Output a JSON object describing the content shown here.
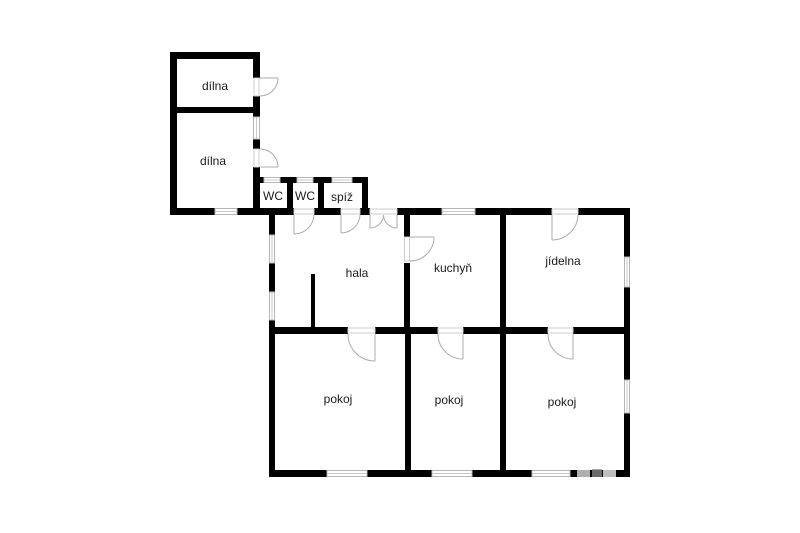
{
  "plan": {
    "type": "floor-plan",
    "background_color": "#ffffff",
    "wall_color": "#000000",
    "door_arc_color": "#ababab",
    "window_line_color": "#b5b5b5",
    "label_color": "#1a1a1a",
    "rooms": [
      {
        "id": "dilna-upper",
        "label": "dílna"
      },
      {
        "id": "dilna-lower",
        "label": "dílna"
      },
      {
        "id": "wc-left",
        "label": "WC"
      },
      {
        "id": "wc-right",
        "label": "WC"
      },
      {
        "id": "spiz",
        "label": "spíž"
      },
      {
        "id": "hala",
        "label": "hala"
      },
      {
        "id": "kuchyn",
        "label": "kuchyň"
      },
      {
        "id": "jidelna",
        "label": "jídelna"
      },
      {
        "id": "pokoj-left",
        "label": "pokoj"
      },
      {
        "id": "pokoj-middle",
        "label": "pokoj"
      },
      {
        "id": "pokoj-right",
        "label": "pokoj"
      }
    ]
  }
}
